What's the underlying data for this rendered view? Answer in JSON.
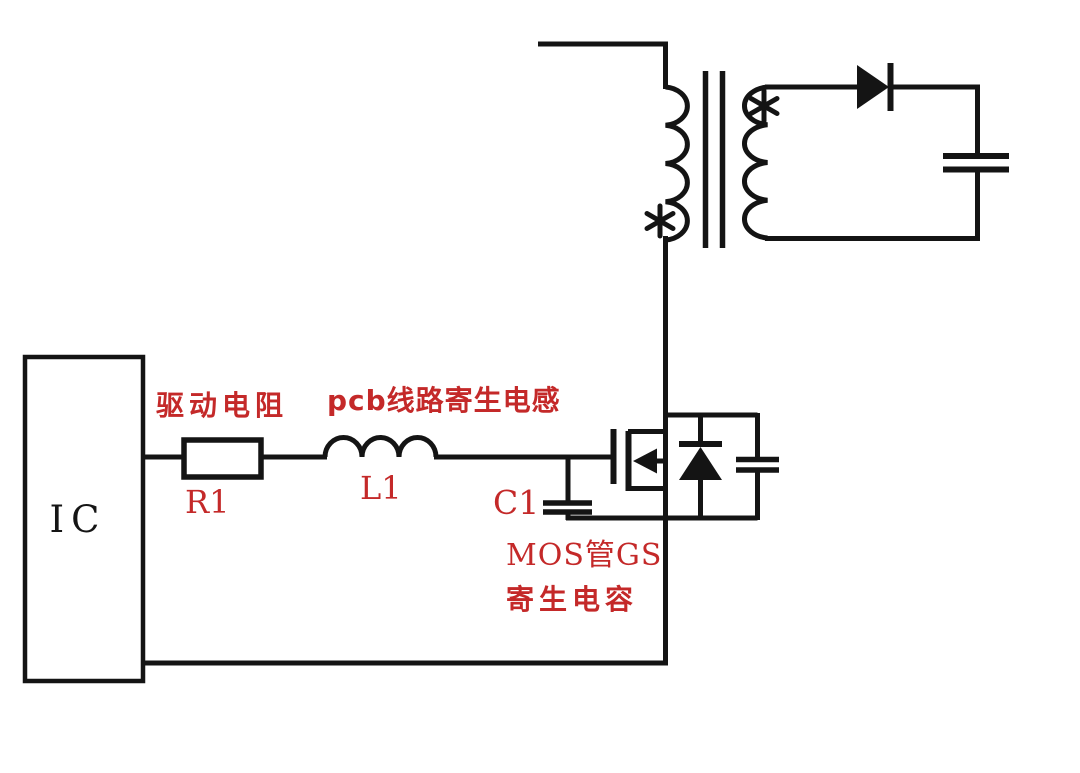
{
  "schematic": {
    "colors": {
      "background": "#ffffff",
      "wire": "#141414",
      "annotation_red": "#c42929",
      "ic_text": "#151515"
    },
    "ic_label": "IC",
    "labels": {
      "drive_resistor": "驱动电阻",
      "r1_ref": "R1",
      "pcb_inductance": "pcb线路寄生电感",
      "l1_ref": "L1",
      "c1_ref": "C1",
      "mos_gs_cap_line1": "MOS管GS",
      "mos_gs_cap_line2": "寄生电容"
    },
    "polarity_marks": {
      "primary": "*",
      "secondary": "*"
    },
    "icons": {
      "resistor": "rectangle-box",
      "inductor": "coil-arcs",
      "capacitor": "parallel-plates",
      "mosfet": "n-mosfet-symbol",
      "body_diode": "diode-pointing-up",
      "output_diode": "diode-pointing-right",
      "transformer": "coupled-coils-with-core",
      "polarity_mark": "asterisk-star"
    }
  }
}
